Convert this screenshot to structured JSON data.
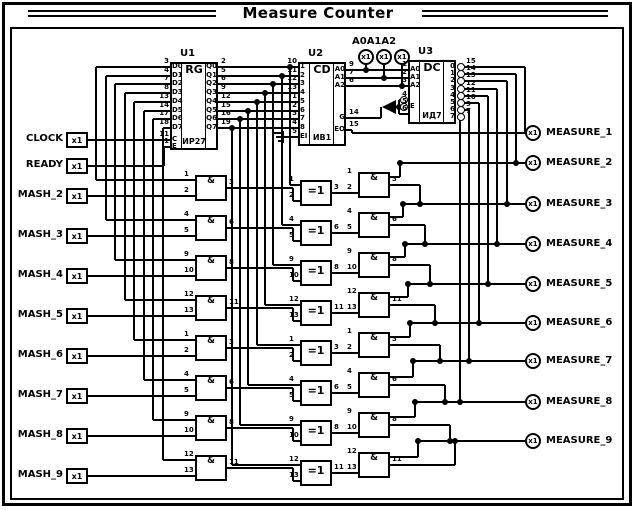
{
  "title": "Measure Counter",
  "top_port_group": {
    "label": "A0A1A2",
    "terminals": [
      "x1",
      "x1",
      "x1"
    ]
  },
  "inputs": [
    {
      "label": "CLOCK",
      "terminal": "x1"
    },
    {
      "label": "READY",
      "terminal": "x1"
    },
    {
      "label": "MASH_2",
      "terminal": "x1"
    },
    {
      "label": "MASH_3",
      "terminal": "x1"
    },
    {
      "label": "MASH_4",
      "terminal": "x1"
    },
    {
      "label": "MASH_5",
      "terminal": "x1"
    },
    {
      "label": "MASH_6",
      "terminal": "x1"
    },
    {
      "label": "MASH_7",
      "terminal": "x1"
    },
    {
      "label": "MASH_8",
      "terminal": "x1"
    },
    {
      "label": "MASH_9",
      "terminal": "x1"
    }
  ],
  "outputs": [
    {
      "label": "MEASURE_1",
      "terminal": "x1"
    },
    {
      "label": "MEASURE_2",
      "terminal": "x1"
    },
    {
      "label": "MEASURE_3",
      "terminal": "x1"
    },
    {
      "label": "MEASURE_4",
      "terminal": "x1"
    },
    {
      "label": "MEASURE_5",
      "terminal": "x1"
    },
    {
      "label": "MEASURE_6",
      "terminal": "x1"
    },
    {
      "label": "MEASURE_7",
      "terminal": "x1"
    },
    {
      "label": "MEASURE_8",
      "terminal": "x1"
    },
    {
      "label": "MEASURE_9",
      "terminal": "x1"
    }
  ],
  "ics": [
    {
      "ref": "U1",
      "function": "RG",
      "part": "ИР27",
      "left_pins": [
        {
          "name": "D0",
          "num": "3"
        },
        {
          "name": "D1",
          "num": "4"
        },
        {
          "name": "D2",
          "num": "7"
        },
        {
          "name": "D3",
          "num": "8"
        },
        {
          "name": "D4",
          "num": "13"
        },
        {
          "name": "D5",
          "num": "14"
        },
        {
          "name": "D6",
          "num": "17"
        },
        {
          "name": "D7",
          "num": "18"
        },
        {
          "name": "C",
          "num": "11"
        },
        {
          "name": "E",
          "num": "1"
        }
      ],
      "right_pins": [
        {
          "name": "Q0",
          "num": "2"
        },
        {
          "name": "Q1",
          "num": "5"
        },
        {
          "name": "Q2",
          "num": "6"
        },
        {
          "name": "Q3",
          "num": "9"
        },
        {
          "name": "Q4",
          "num": "12"
        },
        {
          "name": "Q5",
          "num": "15"
        },
        {
          "name": "Q6",
          "num": "16"
        },
        {
          "name": "Q7",
          "num": "19"
        }
      ]
    },
    {
      "ref": "U2",
      "function": "CD",
      "part": "ИВ1",
      "left_pins": [
        {
          "name": "1",
          "num": "10"
        },
        {
          "name": "2",
          "num": "11"
        },
        {
          "name": "3",
          "num": "12"
        },
        {
          "name": "4",
          "num": "13"
        },
        {
          "name": "5",
          "num": "1"
        },
        {
          "name": "6",
          "num": "2"
        },
        {
          "name": "7",
          "num": "3"
        },
        {
          "name": "8",
          "num": "4"
        },
        {
          "name": "EI",
          "num": "5"
        }
      ],
      "right_pins": [
        {
          "name": "A0",
          "num": "9"
        },
        {
          "name": "A1",
          "num": "7"
        },
        {
          "name": "A2",
          "num": "6"
        },
        {
          "name": "G",
          "num": "14"
        },
        {
          "name": "EO",
          "num": "15"
        }
      ]
    },
    {
      "ref": "U3",
      "function": "DC",
      "part": "ИД7",
      "left_pins": [
        {
          "name": "A0",
          "num": "1"
        },
        {
          "name": "A1",
          "num": "2"
        },
        {
          "name": "A2",
          "num": "3"
        },
        {
          "name": "",
          "num": "4",
          "inv": true
        },
        {
          "name": "E",
          "num": "5",
          "inv": true
        },
        {
          "name": "",
          "num": "6"
        }
      ],
      "right_pins": [
        {
          "name": "0",
          "num": "15",
          "inv": true
        },
        {
          "name": "1",
          "num": "14",
          "inv": true
        },
        {
          "name": "2",
          "num": "13",
          "inv": true
        },
        {
          "name": "3",
          "num": "12",
          "inv": true
        },
        {
          "name": "4",
          "num": "11",
          "inv": true
        },
        {
          "name": "5",
          "num": "10",
          "inv": true
        },
        {
          "name": "6",
          "num": "9",
          "inv": true
        },
        {
          "name": "7",
          "num": "7",
          "inv": true
        }
      ]
    }
  ],
  "gates": {
    "left_and": {
      "label": "&",
      "rows": [
        [
          "1",
          "2",
          "3"
        ],
        [
          "4",
          "5",
          "6"
        ],
        [
          "9",
          "10",
          "8"
        ],
        [
          "12",
          "13",
          "11"
        ],
        [
          "1",
          "2",
          "3"
        ],
        [
          "4",
          "5",
          "6"
        ],
        [
          "9",
          "10",
          "8"
        ],
        [
          "12",
          "13",
          "11"
        ]
      ]
    },
    "xor": {
      "label": "=1",
      "rows": [
        [
          "1",
          "2",
          "3"
        ],
        [
          "4",
          "5",
          "6"
        ],
        [
          "9",
          "10",
          "8"
        ],
        [
          "12",
          "13",
          "11"
        ],
        [
          "1",
          "2",
          "3"
        ],
        [
          "4",
          "5",
          "6"
        ],
        [
          "9",
          "10",
          "8"
        ],
        [
          "12",
          "13",
          "11"
        ]
      ]
    },
    "right_and": {
      "label": "&",
      "rows": [
        [
          "1",
          "2",
          "3"
        ],
        [
          "4",
          "5",
          "6"
        ],
        [
          "9",
          "10",
          "8"
        ],
        [
          "12",
          "13",
          "11"
        ],
        [
          "1",
          "2",
          "3"
        ],
        [
          "4",
          "5",
          "6"
        ],
        [
          "9",
          "10",
          "8"
        ],
        [
          "12",
          "13",
          "11"
        ]
      ]
    }
  }
}
